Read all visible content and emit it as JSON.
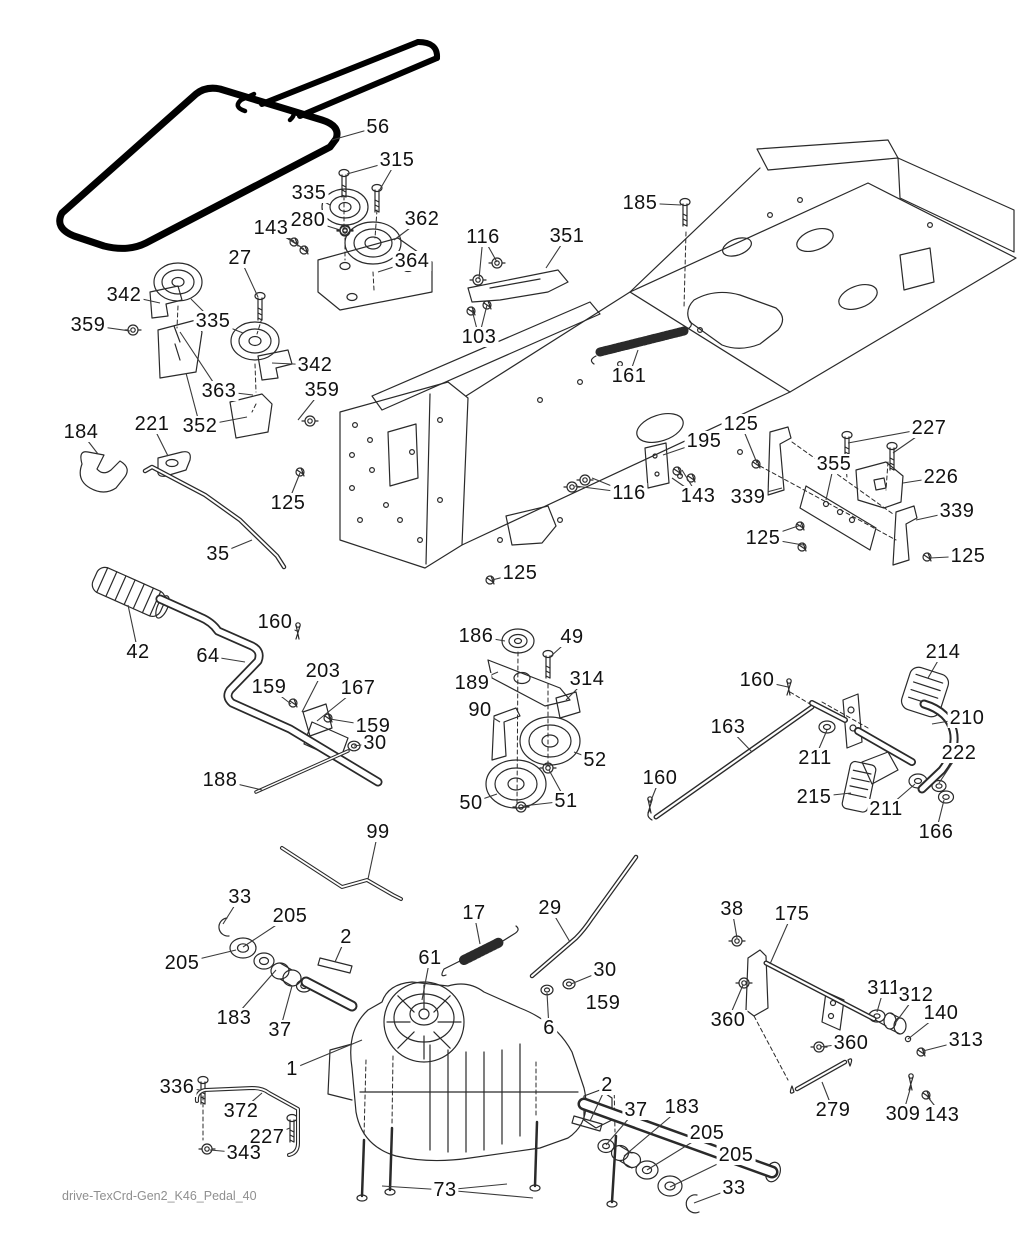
{
  "document": {
    "footer": "drive-TexCrd-Gen2_K46_Pedal_40"
  },
  "colors": {
    "background": "#ffffff",
    "line_art": "#2a2a2a",
    "belt": "#000000",
    "footer_text": "#8f8f8f",
    "label_text": "#111111"
  },
  "callouts": [
    {
      "label": "56",
      "x": 378,
      "y": 127,
      "t": [
        [
          332,
          140
        ]
      ]
    },
    {
      "label": "315",
      "x": 397,
      "y": 160,
      "t": [
        [
          347,
          174
        ],
        [
          379,
          191
        ]
      ]
    },
    {
      "label": "335",
      "x": 309,
      "y": 193,
      "t": [
        [
          330,
          205
        ]
      ]
    },
    {
      "label": "280",
      "x": 308,
      "y": 220,
      "t": [
        [
          340,
          230
        ]
      ]
    },
    {
      "label": "143",
      "x": 271,
      "y": 228,
      "t": [
        [
          294,
          241
        ],
        [
          304,
          249
        ]
      ]
    },
    {
      "label": "27",
      "x": 240,
      "y": 258,
      "t": [
        [
          258,
          297
        ]
      ]
    },
    {
      "label": "362",
      "x": 422,
      "y": 219,
      "t": [
        [
          394,
          240
        ]
      ]
    },
    {
      "label": "364",
      "x": 412,
      "y": 261,
      "t": [
        [
          378,
          272
        ]
      ]
    },
    {
      "label": "185",
      "x": 640,
      "y": 203,
      "t": [
        [
          681,
          205
        ]
      ]
    },
    {
      "label": "116",
      "x": 483,
      "y": 237,
      "t": [
        [
          497,
          262
        ],
        [
          479,
          279
        ]
      ]
    },
    {
      "label": "351",
      "x": 567,
      "y": 236,
      "t": [
        [
          546,
          268
        ]
      ]
    },
    {
      "label": "103",
      "x": 479,
      "y": 337,
      "t": [
        [
          472,
          310
        ],
        [
          487,
          305
        ]
      ]
    },
    {
      "label": "342",
      "x": 124,
      "y": 295,
      "t": [
        [
          160,
          303
        ]
      ]
    },
    {
      "label": "359",
      "x": 88,
      "y": 325,
      "t": [
        [
          130,
          331
        ]
      ]
    },
    {
      "label": "335",
      "x": 213,
      "y": 321,
      "t": [
        [
          191,
          299
        ],
        [
          243,
          333
        ]
      ]
    },
    {
      "label": "363",
      "x": 219,
      "y": 391,
      "t": [
        [
          180,
          332
        ],
        [
          253,
          395
        ]
      ]
    },
    {
      "label": "352",
      "x": 200,
      "y": 426,
      "t": [
        [
          247,
          417
        ],
        [
          186,
          373
        ]
      ]
    },
    {
      "label": "342",
      "x": 315,
      "y": 365,
      "t": [
        [
          272,
          363
        ]
      ]
    },
    {
      "label": "359",
      "x": 322,
      "y": 390,
      "t": [
        [
          298,
          420
        ]
      ]
    },
    {
      "label": "161",
      "x": 629,
      "y": 376,
      "t": [
        [
          638,
          350
        ]
      ]
    },
    {
      "label": "184",
      "x": 81,
      "y": 432,
      "t": [
        [
          98,
          454
        ]
      ]
    },
    {
      "label": "221",
      "x": 152,
      "y": 424,
      "t": [
        [
          168,
          456
        ]
      ]
    },
    {
      "label": "125",
      "x": 288,
      "y": 503,
      "t": [
        [
          300,
          473
        ]
      ]
    },
    {
      "label": "35",
      "x": 218,
      "y": 554,
      "t": [
        [
          252,
          540
        ]
      ]
    },
    {
      "label": "125",
      "x": 741,
      "y": 424,
      "t": [
        [
          757,
          463
        ]
      ]
    },
    {
      "label": "227",
      "x": 929,
      "y": 428,
      "t": [
        [
          848,
          443
        ],
        [
          893,
          453
        ]
      ]
    },
    {
      "label": "195",
      "x": 704,
      "y": 441,
      "t": [
        [
          663,
          455
        ]
      ]
    },
    {
      "label": "355",
      "x": 834,
      "y": 464,
      "t": [
        [
          826,
          500
        ]
      ]
    },
    {
      "label": "226",
      "x": 941,
      "y": 477,
      "t": [
        [
          903,
          483
        ]
      ]
    },
    {
      "label": "339",
      "x": 748,
      "y": 497,
      "t": [
        [
          782,
          488
        ]
      ]
    },
    {
      "label": "143",
      "x": 698,
      "y": 496,
      "t": [
        [
          682,
          470
        ],
        [
          672,
          478
        ]
      ]
    },
    {
      "label": "116",
      "x": 629,
      "y": 493,
      "t": [
        [
          592,
          478
        ],
        [
          575,
          486
        ]
      ]
    },
    {
      "label": "339",
      "x": 957,
      "y": 511,
      "t": [
        [
          916,
          520
        ]
      ]
    },
    {
      "label": "125",
      "x": 763,
      "y": 538,
      "t": [
        [
          801,
          525
        ],
        [
          803,
          545
        ]
      ]
    },
    {
      "label": "125",
      "x": 968,
      "y": 556,
      "t": [
        [
          930,
          558
        ]
      ]
    },
    {
      "label": "125",
      "x": 520,
      "y": 573,
      "t": [
        [
          492,
          580
        ]
      ]
    },
    {
      "label": "42",
      "x": 138,
      "y": 652,
      "t": [
        [
          128,
          605
        ]
      ]
    },
    {
      "label": "64",
      "x": 208,
      "y": 656,
      "t": [
        [
          245,
          662
        ]
      ]
    },
    {
      "label": "160",
      "x": 275,
      "y": 622,
      "t": [
        [
          297,
          631
        ]
      ]
    },
    {
      "label": "159",
      "x": 269,
      "y": 687,
      "t": [
        [
          291,
          704
        ]
      ]
    },
    {
      "label": "203",
      "x": 323,
      "y": 671,
      "t": [
        [
          302,
          712
        ]
      ]
    },
    {
      "label": "167",
      "x": 358,
      "y": 688,
      "t": [
        [
          317,
          721
        ]
      ]
    },
    {
      "label": "159",
      "x": 373,
      "y": 726,
      "t": [
        [
          330,
          719
        ]
      ]
    },
    {
      "label": "30",
      "x": 375,
      "y": 743,
      "t": [
        [
          354,
          746
        ]
      ]
    },
    {
      "label": "188",
      "x": 220,
      "y": 780,
      "t": [
        [
          262,
          790
        ]
      ]
    },
    {
      "label": "186",
      "x": 476,
      "y": 636,
      "t": [
        [
          505,
          641
        ]
      ]
    },
    {
      "label": "49",
      "x": 572,
      "y": 637,
      "t": [
        [
          550,
          657
        ]
      ]
    },
    {
      "label": "189",
      "x": 472,
      "y": 683,
      "t": [
        [
          498,
          672
        ]
      ]
    },
    {
      "label": "314",
      "x": 587,
      "y": 679,
      "t": [
        [
          566,
          700
        ]
      ]
    },
    {
      "label": "90",
      "x": 480,
      "y": 710,
      "t": [
        [
          500,
          722
        ]
      ]
    },
    {
      "label": "52",
      "x": 595,
      "y": 760,
      "t": [
        [
          574,
          752
        ]
      ]
    },
    {
      "label": "50",
      "x": 471,
      "y": 803,
      "t": [
        [
          497,
          794
        ]
      ]
    },
    {
      "label": "51",
      "x": 566,
      "y": 801,
      "t": [
        [
          549,
          770
        ],
        [
          523,
          806
        ]
      ]
    },
    {
      "label": "160",
      "x": 660,
      "y": 778,
      "t": [
        [
          650,
          803
        ]
      ]
    },
    {
      "label": "214",
      "x": 943,
      "y": 652,
      "t": [
        [
          928,
          678
        ]
      ]
    },
    {
      "label": "160",
      "x": 757,
      "y": 680,
      "t": [
        [
          788,
          687
        ]
      ]
    },
    {
      "label": "210",
      "x": 967,
      "y": 718,
      "t": [
        [
          932,
          724
        ]
      ]
    },
    {
      "label": "163",
      "x": 728,
      "y": 727,
      "t": [
        [
          752,
          752
        ]
      ]
    },
    {
      "label": "211",
      "x": 815,
      "y": 758,
      "t": [
        [
          827,
          730
        ]
      ]
    },
    {
      "label": "222",
      "x": 959,
      "y": 753,
      "t": [
        [
          939,
          783
        ]
      ]
    },
    {
      "label": "215",
      "x": 814,
      "y": 797,
      "t": [
        [
          851,
          793
        ]
      ]
    },
    {
      "label": "211",
      "x": 886,
      "y": 809,
      "t": [
        [
          915,
          784
        ]
      ]
    },
    {
      "label": "166",
      "x": 936,
      "y": 832,
      "t": [
        [
          944,
          800
        ]
      ]
    },
    {
      "label": "99",
      "x": 378,
      "y": 832,
      "t": [
        [
          368,
          879
        ]
      ]
    },
    {
      "label": "33",
      "x": 240,
      "y": 897,
      "t": [
        [
          223,
          924
        ]
      ]
    },
    {
      "label": "205",
      "x": 290,
      "y": 916,
      "t": [
        [
          243,
          947
        ]
      ]
    },
    {
      "label": "205",
      "x": 182,
      "y": 963,
      "t": [
        [
          236,
          950
        ]
      ]
    },
    {
      "label": "2",
      "x": 346,
      "y": 937,
      "t": [
        [
          335,
          962
        ]
      ]
    },
    {
      "label": "183",
      "x": 234,
      "y": 1018,
      "t": [
        [
          276,
          970
        ]
      ]
    },
    {
      "label": "37",
      "x": 280,
      "y": 1030,
      "t": [
        [
          292,
          986
        ]
      ]
    },
    {
      "label": "61",
      "x": 430,
      "y": 958,
      "t": [
        [
          422,
          1000
        ]
      ]
    },
    {
      "label": "17",
      "x": 474,
      "y": 913,
      "t": [
        [
          480,
          944
        ]
      ]
    },
    {
      "label": "29",
      "x": 550,
      "y": 908,
      "t": [
        [
          570,
          942
        ]
      ]
    },
    {
      "label": "30",
      "x": 605,
      "y": 970,
      "t": [
        [
          571,
          984
        ]
      ]
    },
    {
      "label": "159",
      "x": 603,
      "y": 1003,
      "t": [
        [
          592,
          1000
        ]
      ]
    },
    {
      "label": "6",
      "x": 549,
      "y": 1028,
      "t": [
        [
          547,
          993
        ]
      ]
    },
    {
      "label": "38",
      "x": 732,
      "y": 909,
      "t": [
        [
          737,
          938
        ]
      ]
    },
    {
      "label": "175",
      "x": 792,
      "y": 914,
      "t": [
        [
          770,
          964
        ]
      ]
    },
    {
      "label": "360",
      "x": 728,
      "y": 1020,
      "t": [
        [
          743,
          985
        ]
      ]
    },
    {
      "label": "311",
      "x": 884,
      "y": 988,
      "t": [
        [
          877,
          1012
        ]
      ]
    },
    {
      "label": "312",
      "x": 916,
      "y": 995,
      "t": [
        [
          896,
          1022
        ]
      ]
    },
    {
      "label": "140",
      "x": 941,
      "y": 1013,
      "t": [
        [
          908,
          1039
        ]
      ]
    },
    {
      "label": "313",
      "x": 966,
      "y": 1040,
      "t": [
        [
          923,
          1051
        ]
      ]
    },
    {
      "label": "360",
      "x": 851,
      "y": 1043,
      "t": [
        [
          820,
          1047
        ]
      ]
    },
    {
      "label": "279",
      "x": 833,
      "y": 1110,
      "t": [
        [
          822,
          1082
        ]
      ]
    },
    {
      "label": "309",
      "x": 903,
      "y": 1114,
      "t": [
        [
          911,
          1086
        ]
      ]
    },
    {
      "label": "143",
      "x": 942,
      "y": 1115,
      "t": [
        [
          927,
          1096
        ]
      ]
    },
    {
      "label": "1",
      "x": 292,
      "y": 1069,
      "t": [
        [
          362,
          1040
        ]
      ]
    },
    {
      "label": "336",
      "x": 177,
      "y": 1087,
      "t": [
        [
          200,
          1090
        ]
      ]
    },
    {
      "label": "372",
      "x": 241,
      "y": 1111,
      "t": [
        [
          262,
          1093
        ]
      ]
    },
    {
      "label": "227",
      "x": 267,
      "y": 1137,
      "t": [
        [
          290,
          1128
        ]
      ]
    },
    {
      "label": "343",
      "x": 244,
      "y": 1153,
      "t": [
        [
          210,
          1150
        ]
      ]
    },
    {
      "label": "73",
      "x": 445,
      "y": 1190,
      "t": [
        [
          382,
          1186
        ],
        [
          507,
          1184
        ],
        [
          533,
          1198
        ]
      ]
    },
    {
      "label": "2",
      "x": 607,
      "y": 1085,
      "t": [
        [
          590,
          1121
        ]
      ]
    },
    {
      "label": "37",
      "x": 636,
      "y": 1110,
      "t": [
        [
          606,
          1145
        ]
      ]
    },
    {
      "label": "183",
      "x": 682,
      "y": 1107,
      "t": [
        [
          624,
          1156
        ]
      ]
    },
    {
      "label": "205",
      "x": 707,
      "y": 1133,
      "t": [
        [
          647,
          1170
        ]
      ]
    },
    {
      "label": "205",
      "x": 736,
      "y": 1155,
      "t": [
        [
          670,
          1187
        ]
      ]
    },
    {
      "label": "33",
      "x": 734,
      "y": 1188,
      "t": [
        [
          694,
          1203
        ]
      ]
    }
  ]
}
